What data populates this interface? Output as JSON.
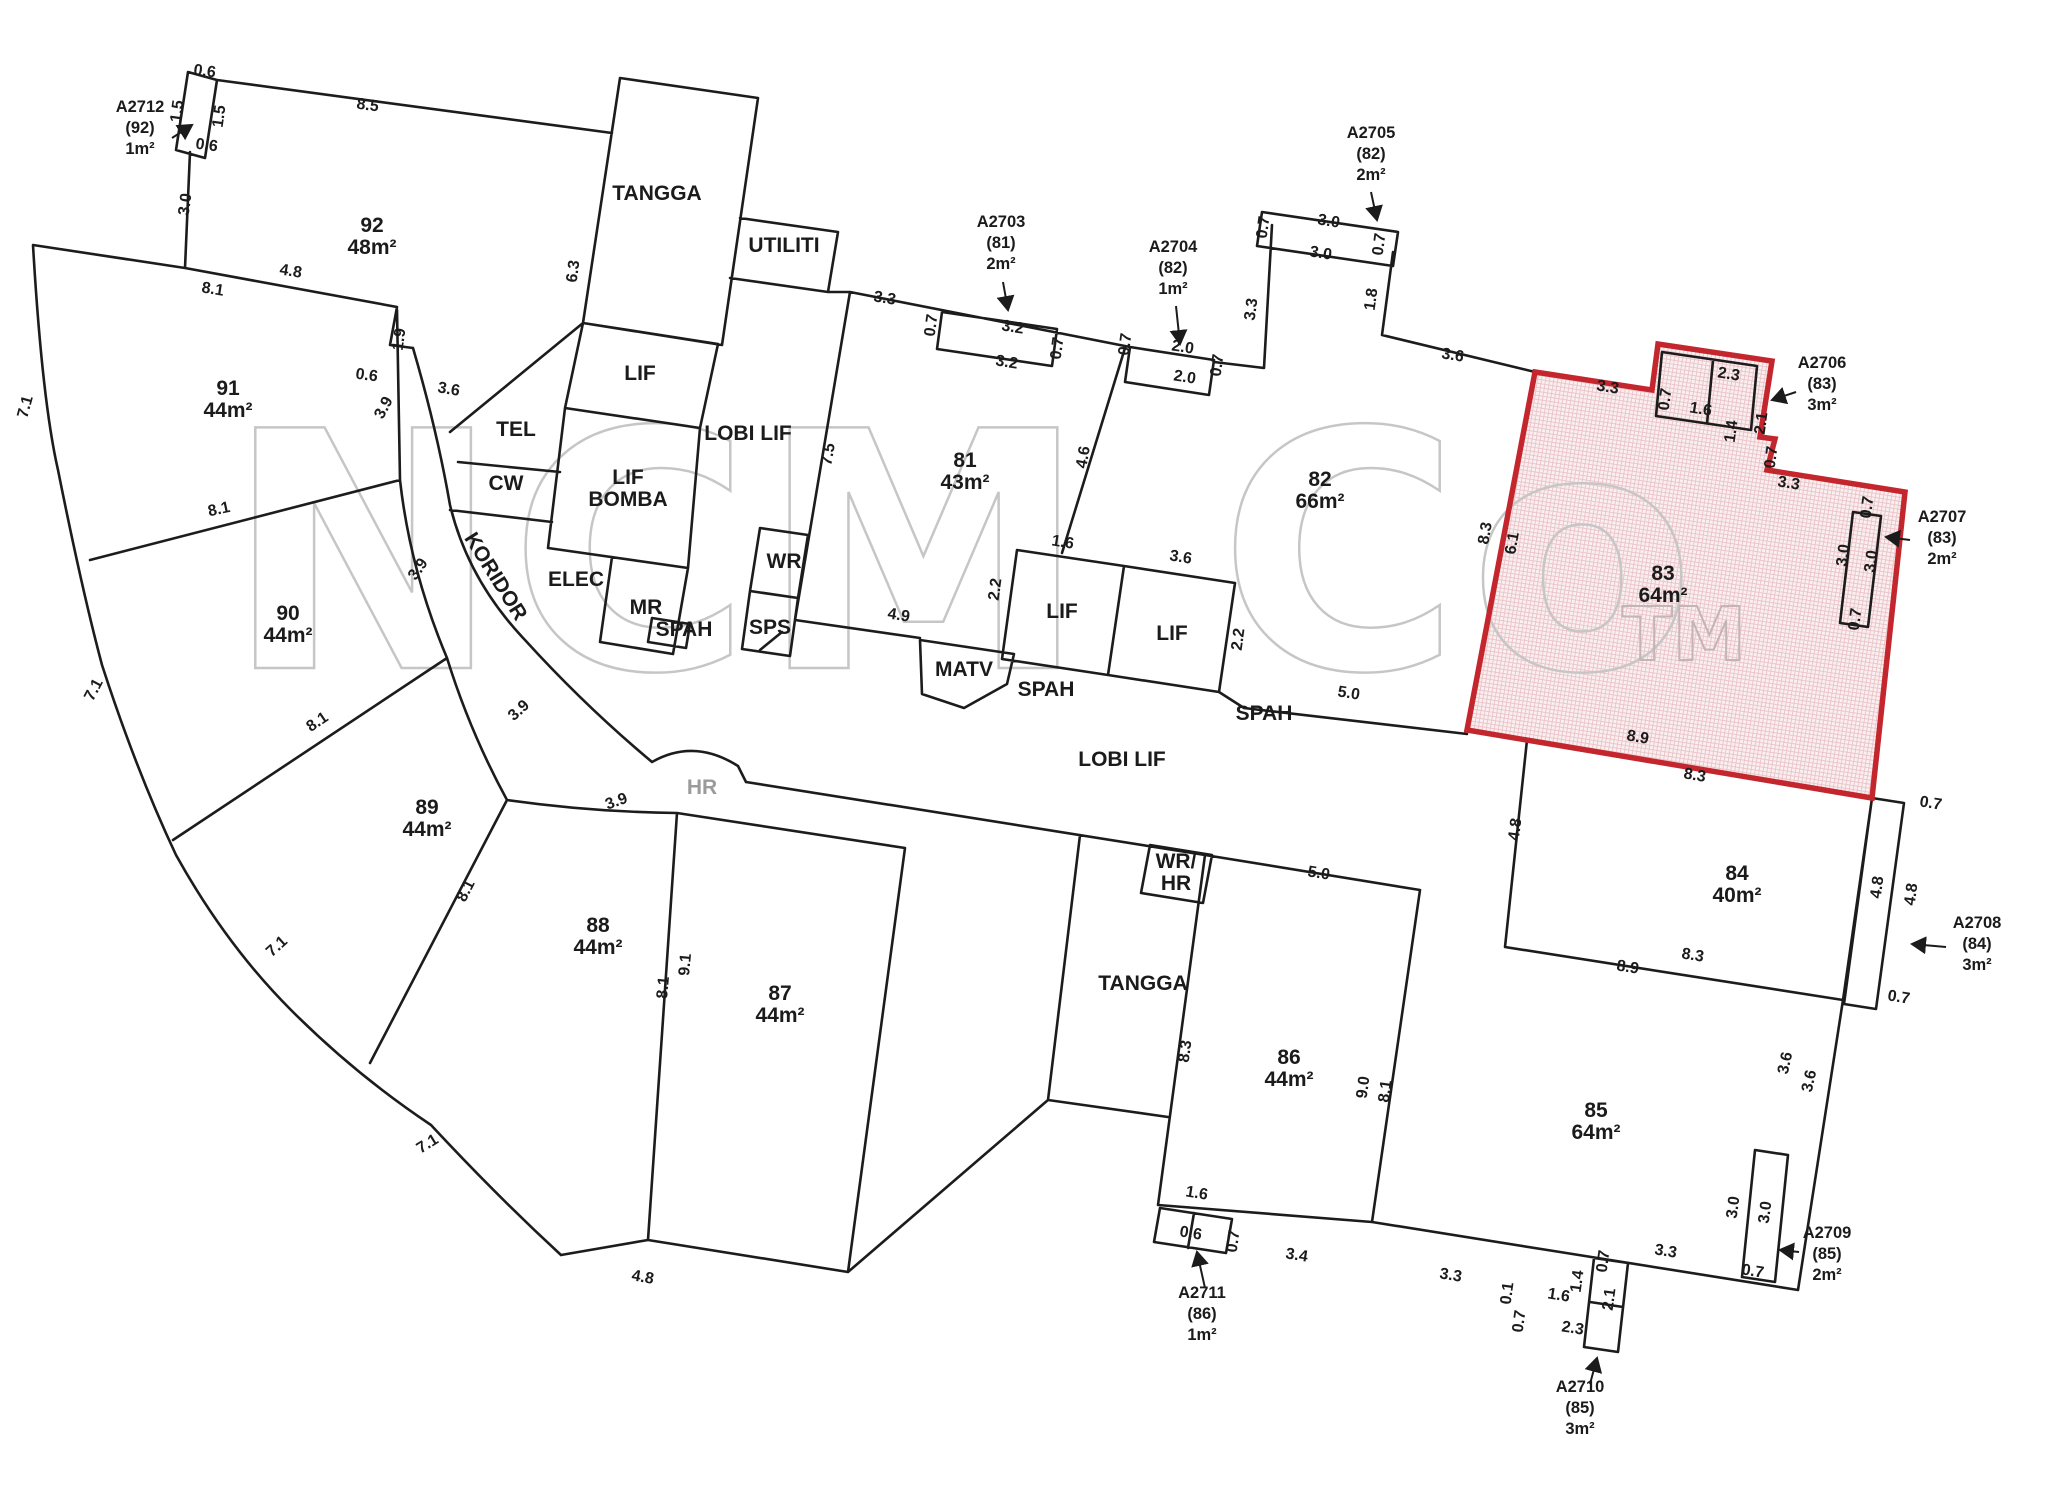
{
  "watermark": {
    "text": "NCM Co",
    "tm": "TM",
    "color": "#c6c6c6"
  },
  "highlight": {
    "unit": "83",
    "border": "#c4262e",
    "fill": "#fbf0f1",
    "hatch": "#eac6ca"
  },
  "units": [
    {
      "id": "92",
      "area": "48m²",
      "x": 372,
      "y": 232
    },
    {
      "id": "91",
      "area": "44m²",
      "x": 228,
      "y": 395
    },
    {
      "id": "90",
      "area": "44m²",
      "x": 288,
      "y": 620
    },
    {
      "id": "89",
      "area": "44m²",
      "x": 427,
      "y": 814
    },
    {
      "id": "88",
      "area": "44m²",
      "x": 598,
      "y": 932
    },
    {
      "id": "87",
      "area": "44m²",
      "x": 780,
      "y": 1000
    },
    {
      "id": "81",
      "area": "43m²",
      "x": 965,
      "y": 467
    },
    {
      "id": "82",
      "area": "66m²",
      "x": 1320,
      "y": 486
    },
    {
      "id": "83",
      "area": "64m²",
      "x": 1663,
      "y": 580
    },
    {
      "id": "84",
      "area": "40m²",
      "x": 1737,
      "y": 880
    },
    {
      "id": "85",
      "area": "64m²",
      "x": 1596,
      "y": 1117
    },
    {
      "id": "86",
      "area": "44m²",
      "x": 1289,
      "y": 1064
    }
  ],
  "rooms": [
    {
      "label": "TANGGA",
      "x": 657,
      "y": 200
    },
    {
      "label": "UTILITI",
      "x": 784,
      "y": 252
    },
    {
      "label": "LIF",
      "x": 640,
      "y": 380
    },
    {
      "label": "TEL",
      "x": 516,
      "y": 436
    },
    {
      "label": "CW",
      "x": 506,
      "y": 490
    },
    {
      "lines": [
        "LIF",
        "BOMBA"
      ],
      "x": 628,
      "y": 484
    },
    {
      "label": "ELEC",
      "x": 576,
      "y": 586
    },
    {
      "label": "MR",
      "x": 646,
      "y": 614
    },
    {
      "label": "WR",
      "x": 784,
      "y": 568
    },
    {
      "label": "SPS",
      "x": 770,
      "y": 634
    },
    {
      "label": "SPAH",
      "x": 684,
      "y": 636
    },
    {
      "label": "MATV",
      "x": 964,
      "y": 676
    },
    {
      "label": "SPAH",
      "x": 1046,
      "y": 696
    },
    {
      "label": "LIF",
      "x": 1062,
      "y": 618
    },
    {
      "label": "LIF",
      "x": 1172,
      "y": 640
    },
    {
      "label": "SPAH",
      "x": 1264,
      "y": 720
    },
    {
      "label": "LOBI LIF",
      "x": 748,
      "y": 440
    },
    {
      "label": "LOBI LIF",
      "x": 1122,
      "y": 766
    },
    {
      "label": "KORIDOR",
      "x": 490,
      "y": 580,
      "r": 58
    },
    {
      "label": "HR",
      "x": 702,
      "y": 794,
      "gray": true
    },
    {
      "label": "TANGGA",
      "x": 1143,
      "y": 990
    },
    {
      "lines": [
        "WR/",
        "HR"
      ],
      "x": 1176,
      "y": 868
    }
  ],
  "dims": [
    {
      "t": "0.6",
      "x": 204,
      "y": 76,
      "r": 8
    },
    {
      "t": "1.5",
      "x": 182,
      "y": 112,
      "r": -82
    },
    {
      "t": "1.5",
      "x": 224,
      "y": 117,
      "r": -82
    },
    {
      "t": "0.6",
      "x": 206,
      "y": 150,
      "r": 8
    },
    {
      "t": "3.0",
      "x": 190,
      "y": 205,
      "r": -82
    },
    {
      "t": "8.5",
      "x": 367,
      "y": 110,
      "r": 8
    },
    {
      "t": "8.1",
      "x": 212,
      "y": 294,
      "r": 9
    },
    {
      "t": "4.8",
      "x": 290,
      "y": 276,
      "r": 9
    },
    {
      "t": "1.9",
      "x": 404,
      "y": 340,
      "r": -82
    },
    {
      "t": "0.6",
      "x": 366,
      "y": 380,
      "r": 8
    },
    {
      "t": "3.6",
      "x": 448,
      "y": 394,
      "r": 10
    },
    {
      "t": "3.9",
      "x": 388,
      "y": 410,
      "r": -62
    },
    {
      "t": "6.3",
      "x": 578,
      "y": 272,
      "r": -82
    },
    {
      "t": "7.1",
      "x": 30,
      "y": 408,
      "r": -75
    },
    {
      "t": "7.1",
      "x": 98,
      "y": 692,
      "r": -62
    },
    {
      "t": "7.1",
      "x": 280,
      "y": 950,
      "r": -42
    },
    {
      "t": "7.1",
      "x": 430,
      "y": 1148,
      "r": -32
    },
    {
      "t": "8.1",
      "x": 220,
      "y": 514,
      "r": -12
    },
    {
      "t": "8.1",
      "x": 320,
      "y": 726,
      "r": -34
    },
    {
      "t": "8.1",
      "x": 470,
      "y": 893,
      "r": -63
    },
    {
      "t": "3.9",
      "x": 422,
      "y": 572,
      "r": -55
    },
    {
      "t": "3.9",
      "x": 522,
      "y": 714,
      "r": -42
    },
    {
      "t": "3.9",
      "x": 618,
      "y": 806,
      "r": -20
    },
    {
      "t": "9.1",
      "x": 690,
      "y": 965,
      "r": -85
    },
    {
      "t": "8.1",
      "x": 668,
      "y": 988,
      "r": -85
    },
    {
      "t": "4.8",
      "x": 642,
      "y": 1282,
      "r": 10
    },
    {
      "t": "7.5",
      "x": 833,
      "y": 455,
      "r": -80
    },
    {
      "t": "3.3",
      "x": 884,
      "y": 303,
      "r": 9
    },
    {
      "t": "0.7",
      "x": 936,
      "y": 326,
      "r": -82
    },
    {
      "t": "3.2",
      "x": 1012,
      "y": 332,
      "r": 9
    },
    {
      "t": "3.2",
      "x": 1006,
      "y": 367,
      "r": 9
    },
    {
      "t": "0.7",
      "x": 1062,
      "y": 349,
      "r": -82
    },
    {
      "t": "0.7",
      "x": 1130,
      "y": 345,
      "r": -82
    },
    {
      "t": "2.0",
      "x": 1182,
      "y": 352,
      "r": 9
    },
    {
      "t": "2.0",
      "x": 1184,
      "y": 382,
      "r": 9
    },
    {
      "t": "0.7",
      "x": 1222,
      "y": 366,
      "r": -82
    },
    {
      "t": "3.3",
      "x": 1256,
      "y": 310,
      "r": -82
    },
    {
      "t": "0.7",
      "x": 1268,
      "y": 228,
      "r": -82
    },
    {
      "t": "3.0",
      "x": 1328,
      "y": 226,
      "r": 9
    },
    {
      "t": "3.0",
      "x": 1320,
      "y": 258,
      "r": 9
    },
    {
      "t": "0.7",
      "x": 1384,
      "y": 245,
      "r": -82
    },
    {
      "t": "1.8",
      "x": 1376,
      "y": 300,
      "r": -82
    },
    {
      "t": "3.6",
      "x": 1452,
      "y": 360,
      "r": 9
    },
    {
      "t": "4.6",
      "x": 1088,
      "y": 458,
      "r": -80
    },
    {
      "t": "1.6",
      "x": 1062,
      "y": 547,
      "r": 9
    },
    {
      "t": "3.6",
      "x": 1180,
      "y": 562,
      "r": 9
    },
    {
      "t": "2.2",
      "x": 1000,
      "y": 590,
      "r": -82
    },
    {
      "t": "2.2",
      "x": 1243,
      "y": 640,
      "r": -82
    },
    {
      "t": "4.9",
      "x": 898,
      "y": 620,
      "r": 9
    },
    {
      "t": "5.0",
      "x": 1348,
      "y": 698,
      "r": 9
    },
    {
      "t": "3.3",
      "x": 1607,
      "y": 392,
      "r": 9
    },
    {
      "t": "0.7",
      "x": 1670,
      "y": 400,
      "r": -82
    },
    {
      "t": "2.3",
      "x": 1728,
      "y": 379,
      "r": 9
    },
    {
      "t": "1.6",
      "x": 1700,
      "y": 414,
      "r": 9
    },
    {
      "t": "1.4",
      "x": 1736,
      "y": 432,
      "r": -82
    },
    {
      "t": "2.1",
      "x": 1766,
      "y": 424,
      "r": -82
    },
    {
      "t": "0.7",
      "x": 1776,
      "y": 458,
      "r": -82
    },
    {
      "t": "3.3",
      "x": 1788,
      "y": 488,
      "r": 9
    },
    {
      "t": "8.3",
      "x": 1490,
      "y": 534,
      "r": -80
    },
    {
      "t": "6.1",
      "x": 1517,
      "y": 544,
      "r": -80
    },
    {
      "t": "3.0",
      "x": 1848,
      "y": 556,
      "r": -82
    },
    {
      "t": "3.0",
      "x": 1876,
      "y": 562,
      "r": -82
    },
    {
      "t": "0.7",
      "x": 1872,
      "y": 508,
      "r": -82
    },
    {
      "t": "0.7",
      "x": 1860,
      "y": 620,
      "r": -82
    },
    {
      "t": "8.9",
      "x": 1637,
      "y": 742,
      "r": 10
    },
    {
      "t": "8.3",
      "x": 1694,
      "y": 780,
      "r": 10
    },
    {
      "t": "4.8",
      "x": 1520,
      "y": 830,
      "r": -82
    },
    {
      "t": "5.0",
      "x": 1318,
      "y": 878,
      "r": 9
    },
    {
      "t": "8.3",
      "x": 1190,
      "y": 1052,
      "r": -82
    },
    {
      "t": "9.0",
      "x": 1368,
      "y": 1088,
      "r": -82
    },
    {
      "t": "8.1",
      "x": 1390,
      "y": 1092,
      "r": -82
    },
    {
      "t": "8.9",
      "x": 1627,
      "y": 972,
      "r": 9
    },
    {
      "t": "8.3",
      "x": 1692,
      "y": 960,
      "r": 9
    },
    {
      "t": "4.8",
      "x": 1882,
      "y": 888,
      "r": -82
    },
    {
      "t": "4.8",
      "x": 1916,
      "y": 895,
      "r": -82
    },
    {
      "t": "0.7",
      "x": 1930,
      "y": 808,
      "r": 9
    },
    {
      "t": "0.7",
      "x": 1898,
      "y": 1002,
      "r": 9
    },
    {
      "t": "3.6",
      "x": 1790,
      "y": 1064,
      "r": -78
    },
    {
      "t": "3.6",
      "x": 1814,
      "y": 1082,
      "r": -78
    },
    {
      "t": "3.0",
      "x": 1738,
      "y": 1208,
      "r": -82
    },
    {
      "t": "3.0",
      "x": 1770,
      "y": 1213,
      "r": -82
    },
    {
      "t": "0.7",
      "x": 1752,
      "y": 1276,
      "r": 9
    },
    {
      "t": "3.3",
      "x": 1665,
      "y": 1256,
      "r": 9
    },
    {
      "t": "1.6",
      "x": 1196,
      "y": 1198,
      "r": 9
    },
    {
      "t": "0.6",
      "x": 1190,
      "y": 1238,
      "r": 9
    },
    {
      "t": "0.7",
      "x": 1238,
      "y": 1242,
      "r": -82
    },
    {
      "t": "3.4",
      "x": 1296,
      "y": 1260,
      "r": 9
    },
    {
      "t": "3.3",
      "x": 1450,
      "y": 1280,
      "r": 9
    },
    {
      "t": "0.1",
      "x": 1512,
      "y": 1294,
      "r": -82
    },
    {
      "t": "1.6",
      "x": 1558,
      "y": 1300,
      "r": 9
    },
    {
      "t": "1.4",
      "x": 1582,
      "y": 1282,
      "r": -82
    },
    {
      "t": "2.1",
      "x": 1614,
      "y": 1300,
      "r": -82
    },
    {
      "t": "0.7",
      "x": 1608,
      "y": 1262,
      "r": -82
    },
    {
      "t": "0.7",
      "x": 1524,
      "y": 1322,
      "r": -82
    },
    {
      "t": "2.3",
      "x": 1572,
      "y": 1333,
      "r": 9
    }
  ],
  "annotations": [
    {
      "lines": [
        "A2712",
        "(92)",
        "1m²"
      ],
      "x": 140,
      "y": 112,
      "arrow": [
        172,
        138,
        192,
        125
      ]
    },
    {
      "lines": [
        "A2703",
        "(81)",
        "2m²"
      ],
      "x": 1001,
      "y": 227,
      "arrow": [
        1003,
        282,
        1008,
        310
      ]
    },
    {
      "lines": [
        "A2704",
        "(82)",
        "1m²"
      ],
      "x": 1173,
      "y": 252,
      "arrow": [
        1176,
        306,
        1180,
        344
      ]
    },
    {
      "lines": [
        "A2705",
        "(82)",
        "2m²"
      ],
      "x": 1371,
      "y": 138,
      "arrow": [
        1371,
        192,
        1377,
        220
      ]
    },
    {
      "lines": [
        "A2706",
        "(83)",
        "3m²"
      ],
      "x": 1822,
      "y": 368,
      "arrow": [
        1796,
        392,
        1772,
        400
      ]
    },
    {
      "lines": [
        "A2707",
        "(83)",
        "2m²"
      ],
      "x": 1942,
      "y": 522,
      "arrow": [
        1910,
        540,
        1886,
        537
      ]
    },
    {
      "lines": [
        "A2708",
        "(84)",
        "3m²"
      ],
      "x": 1977,
      "y": 928,
      "arrow": [
        1946,
        947,
        1912,
        944
      ]
    },
    {
      "lines": [
        "A2709",
        "(85)",
        "2m²"
      ],
      "x": 1827,
      "y": 1238,
      "arrow": [
        1799,
        1252,
        1780,
        1250
      ]
    },
    {
      "lines": [
        "A2710",
        "(85)",
        "3m²"
      ],
      "x": 1580,
      "y": 1392,
      "arrow": [
        1590,
        1384,
        1597,
        1358
      ]
    },
    {
      "lines": [
        "A2711",
        "(86)",
        "1m²"
      ],
      "x": 1202,
      "y": 1298,
      "arrow": [
        1205,
        1288,
        1197,
        1252
      ]
    }
  ]
}
